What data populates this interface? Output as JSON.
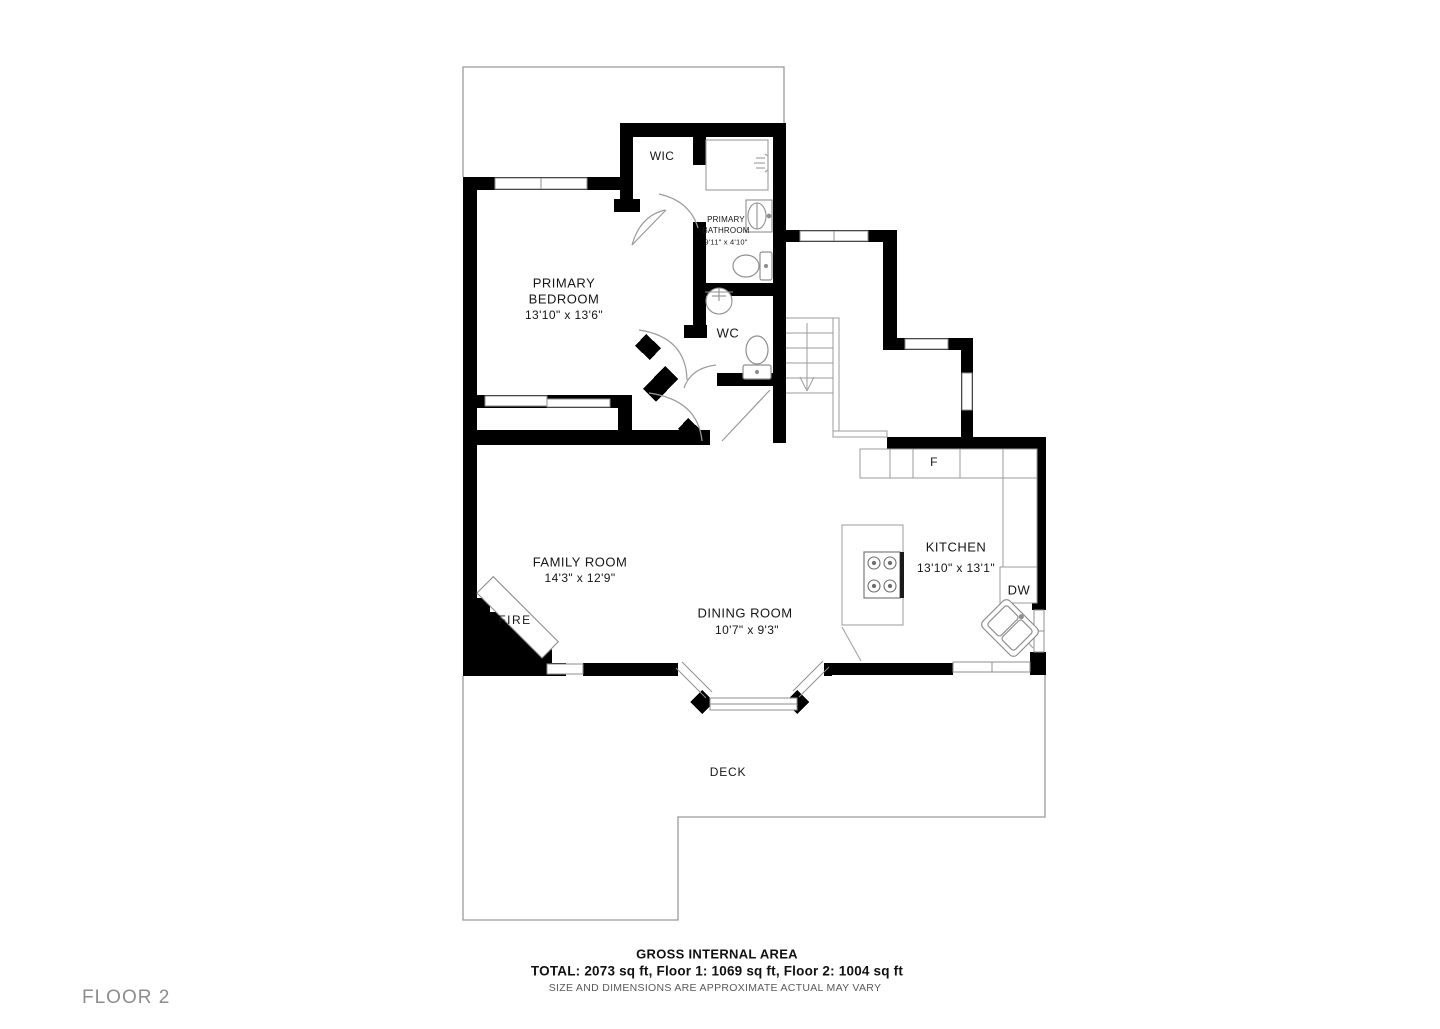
{
  "plan": {
    "floor_label": "FLOOR 2",
    "rooms": {
      "wic": {
        "name": "WIC"
      },
      "primary_bathroom": {
        "name_lines": [
          "PRIMARY",
          "BATHROOM"
        ],
        "dims": "9'11\" x 4'10\""
      },
      "primary_bedroom": {
        "name_lines": [
          "PRIMARY",
          "BEDROOM"
        ],
        "dims": "13'10\" x 13'6\""
      },
      "wc": {
        "name": "WC"
      },
      "family_room": {
        "name": "FAMILY ROOM",
        "dims": "14'3\" x 12'9\""
      },
      "dining_room": {
        "name": "DINING ROOM",
        "dims": "10'7\" x 9'3\""
      },
      "kitchen": {
        "name": "KITCHEN",
        "dims": "13'10\" x 13'1\""
      },
      "deck": {
        "name": "DECK"
      }
    },
    "fixtures": {
      "fireplace": "FIRE",
      "fridge": "F",
      "dishwasher": "DW"
    },
    "colors": {
      "wall": "#000000",
      "line": "#9b9b9b",
      "text": "#161616",
      "muted": "#8c8c8c"
    }
  },
  "footer": {
    "title": "GROSS INTERNAL AREA",
    "totals": "TOTAL: 2073 sq ft, Floor 1: 1069 sq ft, Floor 2: 1004 sq ft",
    "disclaimer": "SIZE AND DIMENSIONS ARE APPROXIMATE ACTUAL MAY VARY"
  }
}
